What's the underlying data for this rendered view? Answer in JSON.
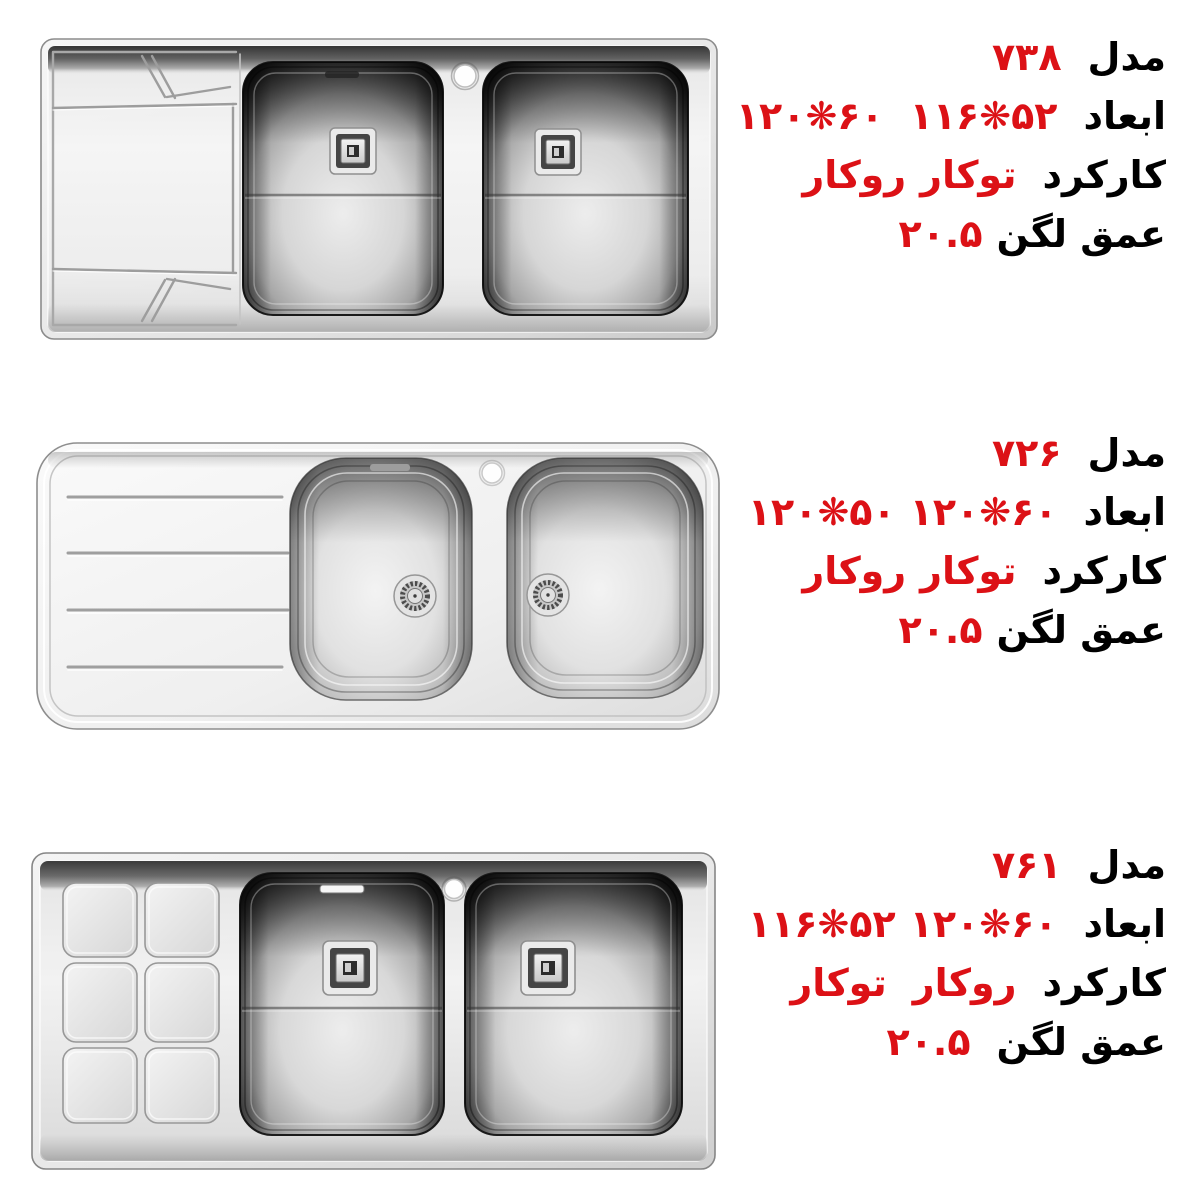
{
  "colors": {
    "accent_red": "#dc1116",
    "text_black": "#000000",
    "background": "#ffffff",
    "steel_light": "#f3f3f3",
    "steel_dark": "#2b2b2b"
  },
  "products": [
    {
      "model_label": "مدل",
      "model_value": "۷۳۸",
      "dims_label": "ابعاد",
      "dims_values": [
        "۱۱۶❋۵۲",
        "۱۲۰❋۶۰"
      ],
      "function_label": "کارکرد",
      "function_values": [
        "توکار",
        "روکار"
      ],
      "depth_label": "عمق لگن",
      "depth_value": "۲۰.۵"
    },
    {
      "model_label": "مدل",
      "model_value": "۷۲۶",
      "dims_label": "ابعاد",
      "dims_values": [
        "۱۲۰❋۶۰",
        "۱۲۰❋۵۰"
      ],
      "function_label": "کارکرد",
      "function_values": [
        "توکار",
        "روکار"
      ],
      "depth_label": "عمق لگن",
      "depth_value": "۲۰.۵"
    },
    {
      "model_label": "مدل",
      "model_value": "۷۶۱",
      "dims_label": "ابعاد",
      "dims_values": [
        "۱۲۰❋۶۰",
        "۱۱۶❋۵۲"
      ],
      "function_label": "کارکرد",
      "function_values": [
        "روکار",
        "توکار"
      ],
      "depth_label": "عمق لگن",
      "depth_value": "۲۰.۵"
    }
  ]
}
